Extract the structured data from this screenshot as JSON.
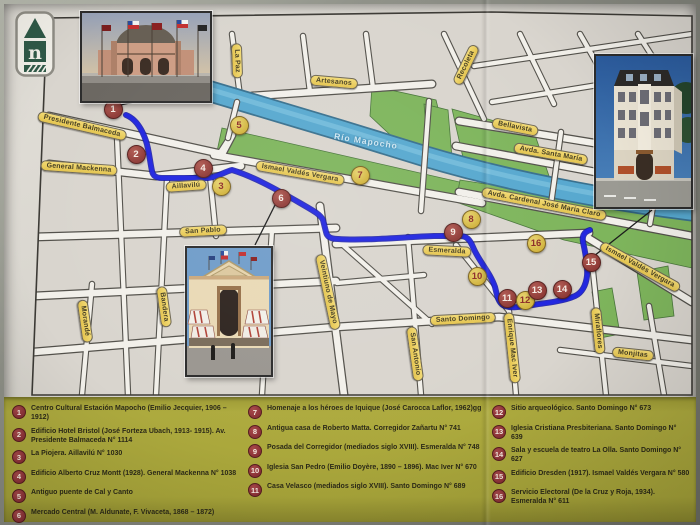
{
  "document": {
    "type": "tourist-walking-map-leaflet",
    "city_area": "Santiago - Río Mapocho riverside"
  },
  "logo": {
    "letter": "n"
  },
  "map": {
    "river_label": "Río Mapocho",
    "route_color": "#2126e0",
    "marker_red_color": "#8e3a36",
    "marker_yellow_color": "#d2b43e",
    "street_pill_color": "#e8cc5c",
    "park_color": "#7eb55c",
    "river_color": "#57a8cf",
    "street_labels": [
      {
        "text": "Presidente Balmaceda",
        "x": 78,
        "y": 122,
        "rot": 13
      },
      {
        "text": "General Mackenna",
        "x": 75,
        "y": 164,
        "rot": 4
      },
      {
        "text": "Aillavilú",
        "x": 182,
        "y": 182,
        "rot": -4
      },
      {
        "text": "La Paz",
        "x": 233,
        "y": 57,
        "rot": 88
      },
      {
        "text": "Artesanos",
        "x": 330,
        "y": 78,
        "rot": 5
      },
      {
        "text": "Recoleta",
        "x": 462,
        "y": 61,
        "rot": -64
      },
      {
        "text": "Ismael Valdés Vergara",
        "x": 296,
        "y": 169,
        "rot": 10
      },
      {
        "text": "Bellavista",
        "x": 511,
        "y": 123,
        "rot": 11
      },
      {
        "text": "Avda. Santa María",
        "x": 547,
        "y": 150,
        "rot": 10
      },
      {
        "text": "Avda. Cardenal José María Claro",
        "x": 540,
        "y": 200,
        "rot": 11
      },
      {
        "text": "Esmeralda",
        "x": 443,
        "y": 247,
        "rot": 3
      },
      {
        "text": "San Pablo",
        "x": 199,
        "y": 227,
        "rot": -3
      },
      {
        "text": "Santo Domingo",
        "x": 459,
        "y": 315,
        "rot": -3
      },
      {
        "text": "Enrique Mac Iver",
        "x": 508,
        "y": 344,
        "rot": 84
      },
      {
        "text": "Miraflores",
        "x": 594,
        "y": 327,
        "rot": 84
      },
      {
        "text": "Monjitas",
        "x": 629,
        "y": 350,
        "rot": 6
      },
      {
        "text": "Bandera",
        "x": 160,
        "y": 303,
        "rot": 82
      },
      {
        "text": "Morandé",
        "x": 81,
        "y": 317,
        "rot": 82
      },
      {
        "text": "Veintiuno de Mayo",
        "x": 324,
        "y": 288,
        "rot": 78
      },
      {
        "text": "San Antonio",
        "x": 411,
        "y": 350,
        "rot": 82
      },
      {
        "text": "Ismael Valdés Vergara",
        "x": 636,
        "y": 263,
        "rot": 29
      }
    ],
    "markers": [
      {
        "n": "1",
        "x": 108,
        "y": 104,
        "variant": "red"
      },
      {
        "n": "2",
        "x": 131,
        "y": 149,
        "variant": "red"
      },
      {
        "n": "3",
        "x": 216,
        "y": 181,
        "variant": "yellow"
      },
      {
        "n": "4",
        "x": 198,
        "y": 163,
        "variant": "red"
      },
      {
        "n": "5",
        "x": 234,
        "y": 120,
        "variant": "yellow"
      },
      {
        "n": "6",
        "x": 276,
        "y": 193,
        "variant": "red"
      },
      {
        "n": "7",
        "x": 355,
        "y": 170,
        "variant": "yellow"
      },
      {
        "n": "8",
        "x": 466,
        "y": 214,
        "variant": "yellow"
      },
      {
        "n": "9",
        "x": 448,
        "y": 227,
        "variant": "red"
      },
      {
        "n": "10",
        "x": 472,
        "y": 271,
        "variant": "yellow"
      },
      {
        "n": "11",
        "x": 502,
        "y": 293,
        "variant": "red"
      },
      {
        "n": "12",
        "x": 520,
        "y": 295,
        "variant": "yellow"
      },
      {
        "n": "13",
        "x": 532,
        "y": 285,
        "variant": "red"
      },
      {
        "n": "14",
        "x": 557,
        "y": 284,
        "variant": "red"
      },
      {
        "n": "15",
        "x": 586,
        "y": 257,
        "variant": "red"
      },
      {
        "n": "16",
        "x": 531,
        "y": 238,
        "variant": "yellow"
      }
    ],
    "inset_photos": [
      {
        "name": "estacion-mapocho-photo",
        "links_marker": "1"
      },
      {
        "name": "edificio-dresden-photo",
        "links_marker": "15"
      },
      {
        "name": "mercado-central-photo",
        "links_marker": "6"
      }
    ]
  },
  "legend": {
    "background_color": "#a8a53a",
    "columns": [
      [
        {
          "n": "1",
          "text": "Centro Cultural Estación Mapocho (Emilio Jecquier, 1906 – 1912)"
        },
        {
          "n": "2",
          "text": "Edificio Hotel Bristol (José Forteza Ubach, 1913- 1915). Av. Presidente Balmaceda N° 1114"
        },
        {
          "n": "3",
          "text": "La Piojera. Aillavilú N° 1030"
        },
        {
          "n": "4",
          "text": "Edificio Alberto Cruz Montt (1928). General Mackenna N° 1038"
        },
        {
          "n": "5",
          "text": "Antiguo puente de Cal y Canto"
        },
        {
          "n": "6",
          "text": "Mercado Central (M. Aldunate, F. Vivaceta, 1868 – 1872)"
        }
      ],
      [
        {
          "n": "7",
          "text": "Homenaje a los héroes de Iquique (José Carocca Laflor, 1962)gg"
        },
        {
          "n": "8",
          "text": "Antigua casa de Roberto Matta. Corregidor Zañartu N° 741"
        },
        {
          "n": "9",
          "text": "Posada del Corregidor (mediados siglo XVIII). Esmeralda N° 748"
        },
        {
          "n": "10",
          "text": "Iglesia San Pedro (Emilio Doyère, 1890 – 1896). Mac Iver N° 670"
        },
        {
          "n": "11",
          "text": "Casa Velasco (mediados siglo XVIII). Santo Domingo N° 689"
        }
      ],
      [
        {
          "n": "12",
          "text": "Sitio arqueológico. Santo Domingo N° 673"
        },
        {
          "n": "13",
          "text": "Iglesia Cristiana Presbiteriana. Santo Domingo N° 639"
        },
        {
          "n": "14",
          "text": "Sala y escuela de teatro La Olla. Santo Domingo N° 627"
        },
        {
          "n": "15",
          "text": "Edificio Dresden (1917). Ismael Valdés Vergara N° 580"
        },
        {
          "n": "16",
          "text": "Servicio Electoral (De la Cruz y Roja, 1934). Esmeralda N° 611"
        }
      ]
    ]
  }
}
